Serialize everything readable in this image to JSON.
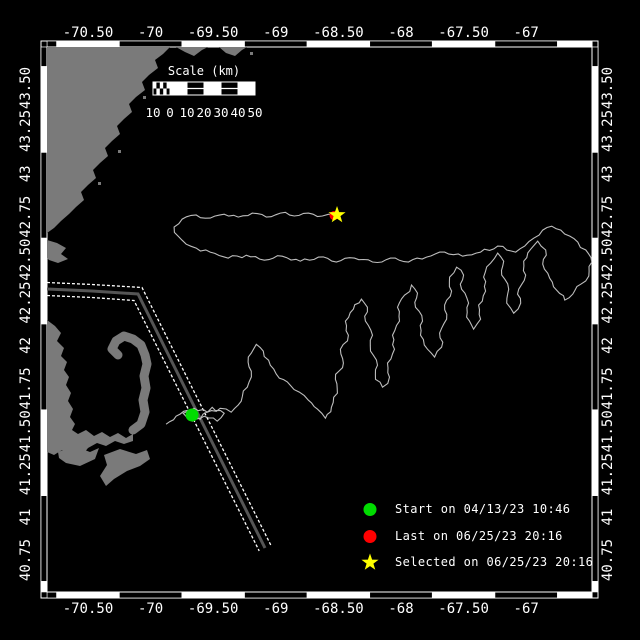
{
  "frame": {
    "lon_min": -70.827,
    "lon_max": -66.473,
    "lat_min": 40.564,
    "lat_max": 43.739,
    "border_style": "alternating-black-white-blocks"
  },
  "axes": {
    "lon_ticks": [
      {
        "value": -70.5,
        "label": "-70.50"
      },
      {
        "value": -70.0,
        "label": "-70"
      },
      {
        "value": -69.5,
        "label": "-69.50"
      },
      {
        "value": -69.0,
        "label": "-69"
      },
      {
        "value": -68.5,
        "label": "-68.50"
      },
      {
        "value": -68.0,
        "label": "-68"
      },
      {
        "value": -67.5,
        "label": "-67.50"
      },
      {
        "value": -67.0,
        "label": "-67"
      }
    ],
    "lat_ticks": [
      {
        "value": 43.5,
        "label": "43.50"
      },
      {
        "value": 43.25,
        "label": "43.25"
      },
      {
        "value": 43.0,
        "label": "43"
      },
      {
        "value": 42.75,
        "label": "42.75"
      },
      {
        "value": 42.5,
        "label": "42.50"
      },
      {
        "value": 42.25,
        "label": "42.25"
      },
      {
        "value": 42.0,
        "label": "42"
      },
      {
        "value": 41.75,
        "label": "41.75"
      },
      {
        "value": 41.5,
        "label": "41.50"
      },
      {
        "value": 41.25,
        "label": "41.25"
      },
      {
        "value": 41.0,
        "label": "41"
      },
      {
        "value": 40.75,
        "label": "40.75"
      }
    ]
  },
  "scale_bar": {
    "title": "Scale (km)",
    "labels": [
      "10",
      "0",
      "10",
      "20",
      "30",
      "40",
      "50"
    ],
    "x": 153,
    "y": 82,
    "width": 102,
    "height": 13,
    "cells": [
      "hatch",
      "white",
      "black",
      "white",
      "black",
      "white"
    ]
  },
  "legend": {
    "items": [
      {
        "marker": "green-circle",
        "label": "Start on 04/13/23 10:46"
      },
      {
        "marker": "red-circle",
        "label": "Last on 06/25/23 20:16"
      },
      {
        "marker": "yellow-star",
        "label": "Selected on 06/25/23 20:16"
      }
    ]
  },
  "markers": {
    "start": {
      "lon": -69.669,
      "lat": 41.595
    },
    "last": {
      "lon": -68.535,
      "lat": 42.757
    },
    "selected": {
      "lon": -68.511,
      "lat": 42.76
    }
  },
  "colors": {
    "background": "#000000",
    "land": "#7a7a7a",
    "track": "#bdbdbd",
    "lane_center": "#555555",
    "lane_edge": "#ffffff",
    "start": "#00dc00",
    "last": "#ff0000",
    "selected": "#ffff00",
    "frame": "#ffffff"
  },
  "overlays_px": {
    "units": "px",
    "land_polygons": [
      [
        [
          47,
          47
        ],
        [
          170,
          47
        ],
        [
          163,
          54
        ],
        [
          155,
          60
        ],
        [
          158,
          68
        ],
        [
          149,
          75
        ],
        [
          142,
          82
        ],
        [
          145,
          90
        ],
        [
          136,
          97
        ],
        [
          129,
          104
        ],
        [
          132,
          112
        ],
        [
          124,
          119
        ],
        [
          117,
          126
        ],
        [
          120,
          134
        ],
        [
          112,
          141
        ],
        [
          105,
          148
        ],
        [
          108,
          156
        ],
        [
          100,
          163
        ],
        [
          93,
          170
        ],
        [
          96,
          178
        ],
        [
          88,
          185
        ],
        [
          81,
          192
        ],
        [
          84,
          200
        ],
        [
          76,
          207
        ],
        [
          69,
          214
        ],
        [
          61,
          221
        ],
        [
          54,
          228
        ],
        [
          47,
          233
        ]
      ],
      [
        [
          176,
          47
        ],
        [
          185,
          52
        ],
        [
          194,
          56
        ],
        [
          202,
          50
        ],
        [
          208,
          47
        ]
      ],
      [
        [
          219,
          47
        ],
        [
          226,
          53
        ],
        [
          235,
          56
        ],
        [
          242,
          50
        ],
        [
          247,
          47
        ]
      ],
      [
        [
          47,
          240
        ],
        [
          57,
          243
        ],
        [
          66,
          248
        ],
        [
          61,
          254
        ],
        [
          68,
          259
        ],
        [
          58,
          263
        ],
        [
          49,
          260
        ],
        [
          47,
          258
        ]
      ],
      [
        [
          47,
          320
        ],
        [
          55,
          326
        ],
        [
          61,
          333
        ],
        [
          57,
          341
        ],
        [
          64,
          348
        ],
        [
          61,
          356
        ],
        [
          67,
          362
        ],
        [
          64,
          370
        ],
        [
          69,
          377
        ],
        [
          66,
          385
        ],
        [
          71,
          393
        ],
        [
          68,
          401
        ],
        [
          73,
          409
        ],
        [
          70,
          417
        ],
        [
          75,
          424
        ],
        [
          72,
          430
        ],
        [
          78,
          434
        ],
        [
          86,
          430
        ],
        [
          94,
          436
        ],
        [
          102,
          432
        ],
        [
          110,
          437
        ],
        [
          118,
          433
        ],
        [
          126,
          438
        ],
        [
          133,
          434
        ],
        [
          133,
          441
        ],
        [
          124,
          444
        ],
        [
          115,
          441
        ],
        [
          106,
          446
        ],
        [
          97,
          443
        ],
        [
          88,
          448
        ],
        [
          84,
          453
        ],
        [
          78,
          450
        ],
        [
          70,
          454
        ],
        [
          62,
          450
        ],
        [
          54,
          455
        ],
        [
          47,
          452
        ]
      ],
      [
        [
          58,
          452
        ],
        [
          74,
          446
        ],
        [
          90,
          452
        ],
        [
          99,
          448
        ],
        [
          95,
          459
        ],
        [
          80,
          466
        ],
        [
          66,
          463
        ],
        [
          59,
          458
        ]
      ],
      [
        [
          104,
          455
        ],
        [
          120,
          449
        ],
        [
          136,
          454
        ],
        [
          147,
          450
        ],
        [
          150,
          459
        ],
        [
          140,
          466
        ],
        [
          127,
          471
        ],
        [
          114,
          479
        ],
        [
          106,
          486
        ],
        [
          100,
          476
        ],
        [
          107,
          465
        ]
      ]
    ],
    "cape_arm": [
      [
        133,
        430
      ],
      [
        141,
        424
      ],
      [
        145,
        412
      ],
      [
        143,
        400
      ],
      [
        146,
        388
      ],
      [
        144,
        376
      ],
      [
        147,
        364
      ],
      [
        145,
        355
      ],
      [
        141,
        345
      ],
      [
        133,
        339
      ],
      [
        124,
        336
      ],
      [
        116,
        341
      ],
      [
        112,
        349
      ],
      [
        118,
        355
      ]
    ],
    "islets": [
      [
        152,
        62
      ],
      [
        143,
        96
      ],
      [
        118,
        150
      ],
      [
        98,
        182
      ],
      [
        250,
        52
      ]
    ],
    "lane": {
      "center": [
        [
          47,
          289
        ],
        [
          92,
          291
        ],
        [
          138,
          294
        ],
        [
          265,
          548
        ]
      ],
      "edge_top": [
        [
          47,
          282.5
        ],
        [
          92,
          284.5
        ],
        [
          142,
          287.5
        ],
        [
          270.8,
          545.1
        ]
      ],
      "edge_bottom": [
        [
          47,
          295.5
        ],
        [
          92,
          297.5
        ],
        [
          134,
          300.5
        ],
        [
          259.2,
          550.9
        ]
      ]
    }
  },
  "chart_data": {
    "type": "line",
    "title": "",
    "xlabel": "longitude",
    "ylabel": "latitude",
    "xlim": [
      -70.827,
      -66.473
    ],
    "ylim": [
      40.564,
      43.739
    ],
    "grid": false,
    "legend_position": "bottom-right",
    "series": [
      {
        "name": "glider-track",
        "points": [
          [
            -69.876,
            41.541
          ],
          [
            -69.796,
            41.588
          ],
          [
            -69.7,
            41.623
          ],
          [
            -69.604,
            41.57
          ],
          [
            -69.508,
            41.64
          ],
          [
            -69.412,
            41.605
          ],
          [
            -69.468,
            41.559
          ],
          [
            -69.572,
            41.588
          ],
          [
            -69.668,
            41.559
          ],
          [
            -69.74,
            41.605
          ],
          [
            -69.652,
            41.634
          ],
          [
            -69.548,
            41.611
          ],
          [
            -69.444,
            41.634
          ],
          [
            -69.356,
            41.611
          ],
          [
            -69.276,
            41.675
          ],
          [
            -69.228,
            41.757
          ],
          [
            -69.196,
            41.85
          ],
          [
            -69.22,
            41.932
          ],
          [
            -69.156,
            42.007
          ],
          [
            -69.1,
            41.967
          ],
          [
            -69.044,
            41.885
          ],
          [
            -68.972,
            41.809
          ],
          [
            -68.884,
            41.768
          ],
          [
            -68.812,
            41.728
          ],
          [
            -68.74,
            41.681
          ],
          [
            -68.668,
            41.629
          ],
          [
            -68.604,
            41.576
          ],
          [
            -68.556,
            41.64
          ],
          [
            -68.508,
            41.722
          ],
          [
            -68.524,
            41.803
          ],
          [
            -68.46,
            41.897
          ],
          [
            -68.484,
            41.978
          ],
          [
            -68.42,
            42.06
          ],
          [
            -68.444,
            42.142
          ],
          [
            -68.38,
            42.212
          ],
          [
            -68.316,
            42.27
          ],
          [
            -68.268,
            42.223
          ],
          [
            -68.284,
            42.142
          ],
          [
            -68.228,
            42.06
          ],
          [
            -68.244,
            41.967
          ],
          [
            -68.188,
            41.885
          ],
          [
            -68.204,
            41.803
          ],
          [
            -68.148,
            41.757
          ],
          [
            -68.092,
            41.815
          ],
          [
            -68.108,
            41.897
          ],
          [
            -68.052,
            41.978
          ],
          [
            -68.068,
            42.06
          ],
          [
            -68.012,
            42.142
          ],
          [
            -68.028,
            42.223
          ],
          [
            -67.972,
            42.293
          ],
          [
            -67.916,
            42.352
          ],
          [
            -67.868,
            42.305
          ],
          [
            -67.884,
            42.223
          ],
          [
            -67.828,
            42.142
          ],
          [
            -67.844,
            42.06
          ],
          [
            -67.788,
            41.978
          ],
          [
            -67.732,
            41.932
          ],
          [
            -67.676,
            41.99
          ],
          [
            -67.692,
            42.072
          ],
          [
            -67.636,
            42.153
          ],
          [
            -67.652,
            42.235
          ],
          [
            -67.596,
            42.317
          ],
          [
            -67.612,
            42.398
          ],
          [
            -67.556,
            42.456
          ],
          [
            -67.5,
            42.41
          ],
          [
            -67.516,
            42.328
          ],
          [
            -67.46,
            42.247
          ],
          [
            -67.476,
            42.165
          ],
          [
            -67.42,
            42.095
          ],
          [
            -67.364,
            42.153
          ],
          [
            -67.38,
            42.235
          ],
          [
            -67.324,
            42.317
          ],
          [
            -67.34,
            42.398
          ],
          [
            -67.284,
            42.48
          ],
          [
            -67.228,
            42.538
          ],
          [
            -67.18,
            42.491
          ],
          [
            -67.196,
            42.41
          ],
          [
            -67.14,
            42.328
          ],
          [
            -67.156,
            42.247
          ],
          [
            -67.1,
            42.188
          ],
          [
            -67.044,
            42.247
          ],
          [
            -67.06,
            42.328
          ],
          [
            -67.004,
            42.41
          ],
          [
            -67.02,
            42.491
          ],
          [
            -66.964,
            42.561
          ],
          [
            -66.908,
            42.608
          ],
          [
            -66.844,
            42.556
          ],
          [
            -66.868,
            42.474
          ],
          [
            -66.812,
            42.392
          ],
          [
            -66.756,
            42.322
          ],
          [
            -66.692,
            42.264
          ],
          [
            -66.628,
            42.299
          ],
          [
            -66.564,
            42.357
          ],
          [
            -66.5,
            42.404
          ],
          [
            -66.476,
            42.485
          ],
          [
            -66.524,
            42.556
          ],
          [
            -66.588,
            42.602
          ],
          [
            -66.652,
            42.637
          ],
          [
            -66.724,
            42.672
          ],
          [
            -66.796,
            42.695
          ],
          [
            -66.868,
            42.672
          ],
          [
            -66.94,
            42.625
          ],
          [
            -67.012,
            42.579
          ],
          [
            -67.084,
            42.544
          ],
          [
            -67.156,
            42.556
          ],
          [
            -67.228,
            42.579
          ],
          [
            -67.364,
            42.544
          ],
          [
            -67.508,
            42.52
          ],
          [
            -67.652,
            42.544
          ],
          [
            -67.796,
            42.515
          ],
          [
            -67.94,
            42.486
          ],
          [
            -68.084,
            42.509
          ],
          [
            -68.228,
            42.486
          ],
          [
            -68.372,
            42.509
          ],
          [
            -68.516,
            42.486
          ],
          [
            -68.66,
            42.515
          ],
          [
            -68.804,
            42.491
          ],
          [
            -68.948,
            42.52
          ],
          [
            -69.092,
            42.497
          ],
          [
            -69.236,
            42.526
          ],
          [
            -69.38,
            42.509
          ],
          [
            -69.524,
            42.544
          ],
          [
            -69.636,
            42.567
          ],
          [
            -69.716,
            42.59
          ],
          [
            -69.78,
            42.637
          ],
          [
            -69.812,
            42.69
          ],
          [
            -69.748,
            42.736
          ],
          [
            -69.636,
            42.76
          ],
          [
            -69.524,
            42.742
          ],
          [
            -69.412,
            42.765
          ],
          [
            -69.3,
            42.748
          ],
          [
            -69.188,
            42.771
          ],
          [
            -69.076,
            42.748
          ],
          [
            -68.964,
            42.771
          ],
          [
            -68.852,
            42.754
          ],
          [
            -68.74,
            42.771
          ],
          [
            -68.628,
            42.754
          ],
          [
            -68.532,
            42.765
          ],
          [
            -68.508,
            42.76
          ]
        ]
      }
    ]
  }
}
